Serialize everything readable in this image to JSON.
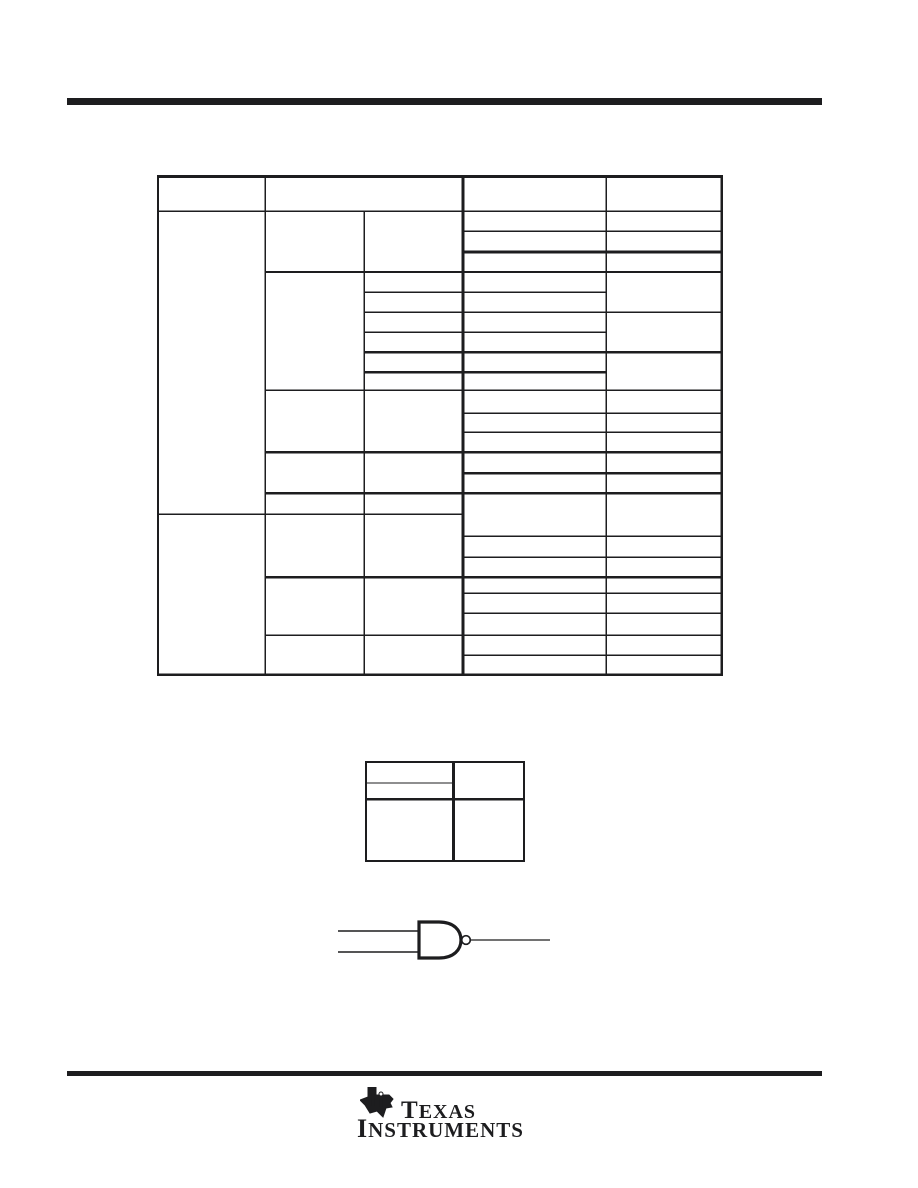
{
  "document": {
    "background": "#ffffff",
    "ink_color": "#1d1d1f"
  },
  "logo": {
    "word1": "TEXAS",
    "word2": "INSTRUMENTS",
    "icon": "ti-texas-map-icon"
  }
}
